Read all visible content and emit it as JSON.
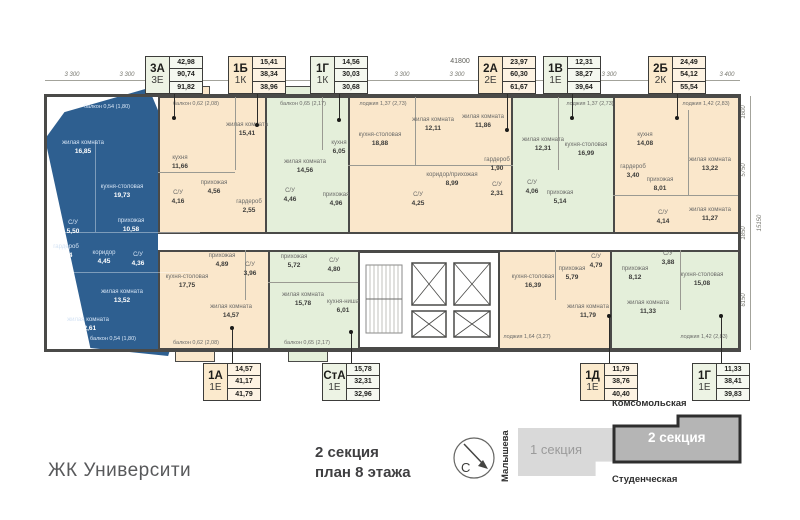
{
  "titles": {
    "brand": "ЖК Университи",
    "plan_line1": "2 секция",
    "plan_line2": "план 8 этажа"
  },
  "colors": {
    "highlight_blue": "#2e5f90",
    "unit_orange": "#fae7cb",
    "unit_green": "#e4efda",
    "walls": "#4a4a48",
    "card_green": "#edf3e4",
    "card_orange": "#fbeacd"
  },
  "legend_top": [
    {
      "type": "3А",
      "cls": "3Е",
      "living": "42,98",
      "area": "90,74",
      "total": "91,82"
    },
    {
      "type": "1Б",
      "cls": "1К",
      "living": "15,41",
      "area": "38,34",
      "total": "38,96"
    },
    {
      "type": "1Г",
      "cls": "1К",
      "living": "14,56",
      "area": "30,03",
      "total": "30,68"
    },
    {
      "type": "2А",
      "cls": "2Е",
      "living": "23,97",
      "area": "60,30",
      "total": "61,67"
    },
    {
      "type": "1В",
      "cls": "1Е",
      "living": "12,31",
      "area": "38,27",
      "total": "39,64"
    },
    {
      "type": "2Б",
      "cls": "2К",
      "living": "24,49",
      "area": "54,12",
      "total": "55,54"
    }
  ],
  "legend_bottom": [
    {
      "type": "1А",
      "cls": "1Е",
      "living": "14,57",
      "area": "41,17",
      "total": "41,79"
    },
    {
      "type": "СтА",
      "cls": "1Е",
      "living": "15,78",
      "area": "32,31",
      "total": "32,96"
    },
    {
      "type": "1Д",
      "cls": "1Е",
      "living": "11,79",
      "area": "38,76",
      "total": "40,40"
    },
    {
      "type": "1Г",
      "cls": "1Е",
      "living": "11,33",
      "area": "38,41",
      "total": "39,83"
    }
  ],
  "apartments": [
    {
      "id": "3А",
      "rooms": [
        {
          "name": "жилая комната",
          "area": "16,85"
        },
        {
          "name": "кухня-столовая",
          "area": "19,73"
        },
        {
          "name": "С/У",
          "area": "5,50"
        },
        {
          "name": "прихожая",
          "area": "10,58"
        },
        {
          "name": "гардероб",
          "area": "3,14"
        },
        {
          "name": "коридор",
          "area": "4,45"
        },
        {
          "name": "С/У",
          "area": "4,36"
        },
        {
          "name": "жилая комната",
          "area": "13,52"
        },
        {
          "name": "жилая комната",
          "area": "12,61"
        }
      ],
      "balcony_top": "балкон 0,54 (1,80)",
      "balcony_bottom": "балкон 0,54 (1,80)"
    },
    {
      "id": "1Б",
      "rooms": [
        {
          "name": "кухня",
          "area": "11,66"
        },
        {
          "name": "жилая комната",
          "area": "15,41"
        },
        {
          "name": "прихожая",
          "area": "4,56"
        },
        {
          "name": "С/У",
          "area": "4,16"
        },
        {
          "name": "гардероб",
          "area": "2,55"
        }
      ],
      "balcony": "балкон 0,62 (2,08)"
    },
    {
      "id": "1Г",
      "rooms": [
        {
          "name": "кухня",
          "area": "6,05"
        },
        {
          "name": "жилая комната",
          "area": "14,56"
        },
        {
          "name": "прихожая",
          "area": "4,96"
        },
        {
          "name": "С/У",
          "area": "4,46"
        }
      ],
      "balcony": "балкон 0,65 (2,17)"
    },
    {
      "id": "2А",
      "rooms": [
        {
          "name": "кухня-столовая",
          "area": "18,88"
        },
        {
          "name": "жилая комната",
          "area": "12,11"
        },
        {
          "name": "жилая комната",
          "area": "11,86"
        },
        {
          "name": "коридор/прихожая",
          "area": "8,99"
        },
        {
          "name": "С/У",
          "area": "4,25"
        },
        {
          "name": "С/У",
          "area": "2,31"
        },
        {
          "name": "гардероб",
          "area": "1,90"
        }
      ],
      "loggia": "лоджия 1,37 (2,73)"
    },
    {
      "id": "1В",
      "rooms": [
        {
          "name": "жилая комната",
          "area": "12,31"
        },
        {
          "name": "кухня-столовая",
          "area": "16,99"
        },
        {
          "name": "прихожая",
          "area": "5,14"
        },
        {
          "name": "С/У",
          "area": "4,06"
        }
      ],
      "loggia": "лоджия 1,37 (2,73)"
    },
    {
      "id": "2Б",
      "rooms": [
        {
          "name": "кухня",
          "area": "14,08"
        },
        {
          "name": "жилая комната",
          "area": "13,22"
        },
        {
          "name": "жилая комната",
          "area": "11,27"
        },
        {
          "name": "прихожая",
          "area": "8,01"
        },
        {
          "name": "гардероб",
          "area": "3,40"
        },
        {
          "name": "С/У",
          "area": "4,14"
        }
      ],
      "loggia": "лоджия 1,42 (2,83)"
    },
    {
      "id": "1А",
      "rooms": [
        {
          "name": "кухня-столовая",
          "area": "17,75"
        },
        {
          "name": "жилая комната",
          "area": "14,57"
        },
        {
          "name": "прихожая",
          "area": "4,89"
        },
        {
          "name": "С/У",
          "area": "3,96"
        }
      ],
      "balcony": "балкон 0,62 (2,08)"
    },
    {
      "id": "СтА",
      "rooms": [
        {
          "name": "жилая комната",
          "area": "15,78"
        },
        {
          "name": "кухня-ниша",
          "area": "6,01"
        },
        {
          "name": "прихожая",
          "area": "5,72"
        },
        {
          "name": "С/У",
          "area": "4,80"
        }
      ],
      "balcony": "балкон 0,65 (2,17)"
    },
    {
      "id": "1Д",
      "rooms": [
        {
          "name": "кухня-столовая",
          "area": "16,39"
        },
        {
          "name": "жилая комната",
          "area": "11,79"
        },
        {
          "name": "прихожая",
          "area": "5,79"
        },
        {
          "name": "С/У",
          "area": "4,79"
        }
      ],
      "loggia": "лоджия 1,64 (3,27)"
    },
    {
      "id": "1Г",
      "rooms": [
        {
          "name": "кухня-столовая",
          "area": "15,08"
        },
        {
          "name": "жилая комната",
          "area": "11,33"
        },
        {
          "name": "прихожая",
          "area": "8,12"
        },
        {
          "name": "С/У",
          "area": "3,88"
        }
      ],
      "loggia": "лоджия 1,42 (2,83)"
    }
  ],
  "dimensions": {
    "overall_top": "41800",
    "top": [
      "3 300",
      "3 300",
      "3 600",
      "3 600",
      "6 000",
      "3 300",
      "3 300",
      "3 300",
      "2 500",
      "3 300",
      "4 100",
      "3 400"
    ],
    "right": [
      "1600",
      "5750",
      "1850",
      "6150"
    ],
    "overall_right": "15150"
  },
  "site_plan": {
    "compass": "С",
    "street_left": "Малышева",
    "street_top": "Комсомольская",
    "street_bottom": "Студенческая",
    "section_1": "1 секция",
    "section_2": "2 секция"
  }
}
